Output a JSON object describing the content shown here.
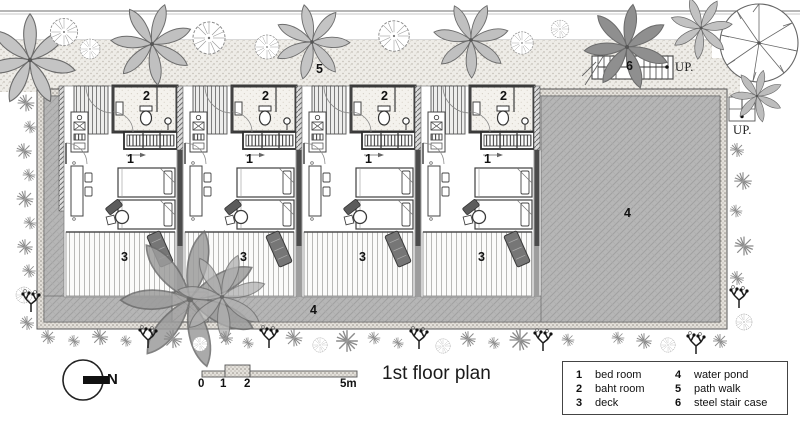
{
  "title": "1st floor plan",
  "compass": {
    "north_label": "N"
  },
  "scalebar": {
    "ticks": [
      "0",
      "1",
      "2",
      "5m"
    ]
  },
  "plan": {
    "room_labels": {
      "bedroom": "1",
      "bathroom": "2",
      "deck": "3",
      "pond": "4",
      "path": "5",
      "stair": "6"
    },
    "up_labels": {
      "stair_top": "UP.",
      "pond_corner": "UP."
    }
  },
  "legend": {
    "items": [
      {
        "num": "1",
        "label": "bed room"
      },
      {
        "num": "2",
        "label": "baht room"
      },
      {
        "num": "3",
        "label": "deck"
      },
      {
        "num": "4",
        "label": "water pond"
      },
      {
        "num": "5",
        "label": "path walk"
      },
      {
        "num": "6",
        "label": "steel stair case"
      }
    ]
  },
  "colors": {
    "pond_gray": "#b6b6b6",
    "wall_dark": "#3a3a3a",
    "path_sand": "#eeece7"
  }
}
